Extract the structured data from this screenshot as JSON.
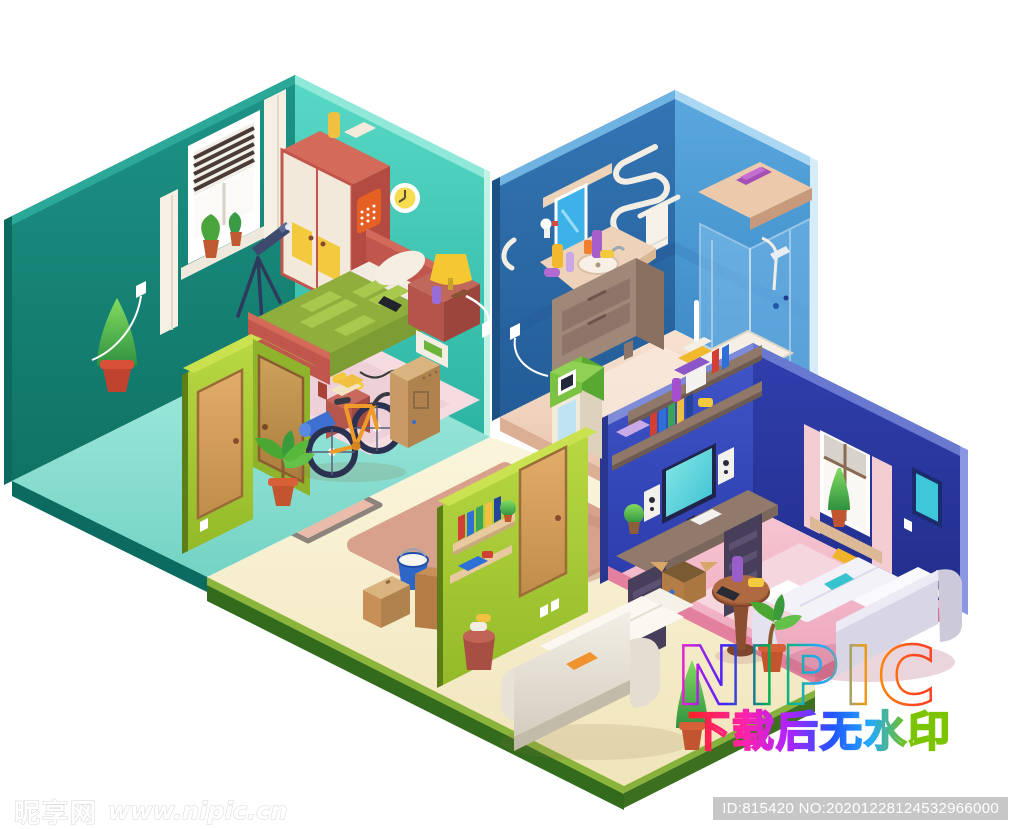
{
  "image": {
    "type": "stock-illustration preview",
    "subject": "isometric cutaway apartment with bedroom, bathroom, hallway and living room"
  },
  "watermark": {
    "brand": "NIPIC",
    "slogan": "下载后无水印"
  },
  "footer": {
    "site_name": "昵享网",
    "site_url": "www.nipic.cn",
    "image_id": "ID:815420 NO:20201228124532966000"
  },
  "palette": {
    "bedroom_wall_dark": "#1d9486",
    "bedroom_wall_light": "#4ed2bf",
    "bedroom_floor": "#8fe4d8",
    "bathroom_wall_dark": "#2e6fae",
    "bathroom_wall_light": "#55a5dc",
    "bathroom_floor": "#f2d3be",
    "living_wall_left": "#3a4ec2",
    "living_wall_right": "#2c3ba8",
    "living_floor": "#f2b6c6",
    "hall_wall_green": "#a9cd37",
    "hall_floor_cream": "#f8f1cd",
    "rug_tan": "#d7a18c",
    "wood_door": "#d8a360",
    "bed_red": "#c0564c",
    "bike_orange": "#f09a28",
    "badge_gray": "#c7c7c7"
  },
  "scene": {
    "rooms": [
      "bedroom",
      "bathroom",
      "hallway",
      "living-room"
    ]
  }
}
